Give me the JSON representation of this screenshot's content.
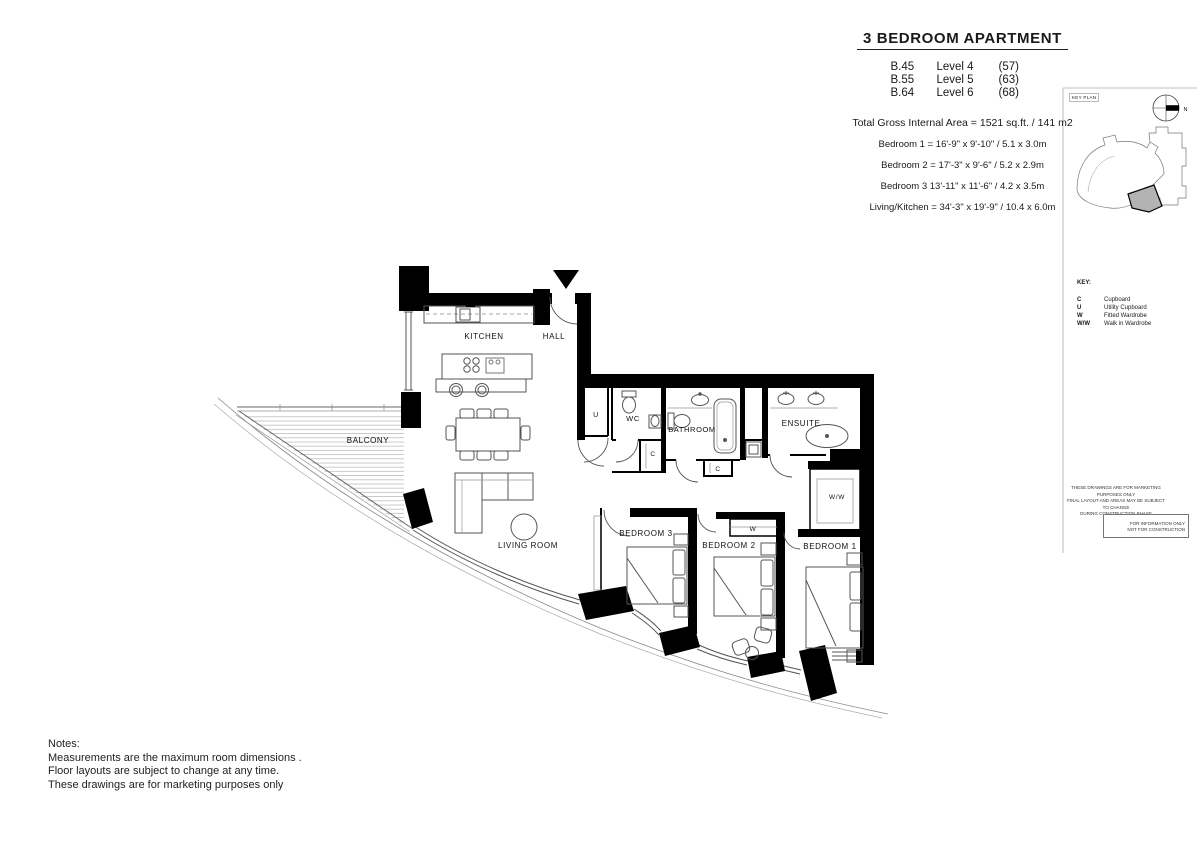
{
  "title_block": {
    "title": "3 BEDROOM APARTMENT",
    "units": [
      {
        "code": "B.45",
        "level": "Level 4",
        "count": "(57)"
      },
      {
        "code": "B.55",
        "level": "Level 5",
        "count": "(63)"
      },
      {
        "code": "B.64",
        "level": "Level 6",
        "count": "(68)"
      }
    ],
    "total_area": "Total Gross Internal Area = 1521 sq.ft. / 141 m2",
    "dimensions": [
      "Bedroom 1 = 16'-9\" x 9'-10\" / 5.1 x 3.0m",
      "Bedroom 2 = 17'-3\" x 9'-6\" / 5.2 x 2.9m",
      "Bedroom 3  13'-11\" x 11'-6\" / 4.2 x 3.5m",
      "Living/Kitchen = 34'-3\" x 19'-9\" / 10.4 x 6.0m"
    ]
  },
  "key_plan": {
    "label": "KEY PLAN",
    "compass_north": "N"
  },
  "key_legend": {
    "heading": "KEY:",
    "entries": [
      {
        "abbr": "C",
        "label": "Cupboard"
      },
      {
        "abbr": "U",
        "label": "Utility Cupboard"
      },
      {
        "abbr": "W",
        "label": "Fitted Wardrobe"
      },
      {
        "abbr": "W/W",
        "label": "Walk in Wardrobe"
      }
    ]
  },
  "disclaimer": {
    "lines": [
      "THESE DRAWINGS ARE FOR MARKETING PURPOSES ONLY",
      "FINAL LAYOUT AND AREAS MAY BE SUBJECT TO CHANGE",
      "DURING CONSTRUCTION PHASE"
    ],
    "stamp": [
      "FOR INFORMATION ONLY",
      "NOT FOR CONSTRUCTION"
    ]
  },
  "plan": {
    "rooms": {
      "kitchen": "KITCHEN",
      "hall": "HALL",
      "balcony": "BALCONY",
      "living": "LIVING ROOM",
      "bedroom3": "BEDROOM 3",
      "bedroom2": "BEDROOM 2",
      "bedroom1": "BEDROOM 1",
      "bathroom": "BATHROOM",
      "ensuite": "ENSUITE",
      "wc": "WC",
      "u": "U",
      "c1": "C",
      "c2": "C",
      "w": "W",
      "ww": "W/W"
    }
  },
  "notes": {
    "heading": "Notes:",
    "lines": [
      "Measurements are the maximum room dimensions .",
      "Floor layouts are subject to change at any time.",
      "These drawings are for marketing purposes only"
    ]
  },
  "colors": {
    "wall": "#000000",
    "thin_line": "#555555",
    "deck_line": "#b5b5b5",
    "highlight": "#b3b3b3"
  }
}
